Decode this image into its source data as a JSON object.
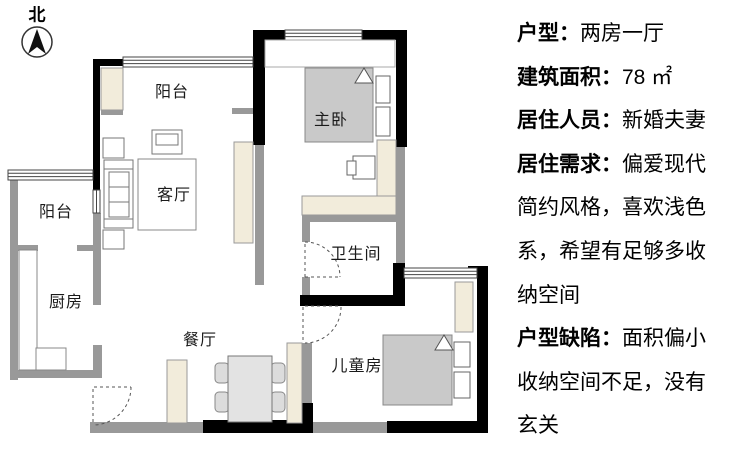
{
  "compass": {
    "label": "北"
  },
  "floorplan": {
    "rooms": [
      {
        "id": "balcony-top",
        "label": "阳台"
      },
      {
        "id": "master-bedroom",
        "label": "主卧"
      },
      {
        "id": "living-room",
        "label": "客厅"
      },
      {
        "id": "balcony-left",
        "label": "阳台"
      },
      {
        "id": "kitchen",
        "label": "厨房"
      },
      {
        "id": "bathroom",
        "label": "卫生间"
      },
      {
        "id": "dining-room",
        "label": "餐厅"
      },
      {
        "id": "kids-room",
        "label": "儿童房"
      }
    ],
    "colors": {
      "wall_black": "#000000",
      "wall_gray": "#999999",
      "furniture_beige": "#f2ecdb",
      "bed_gray": "#c9c9c9",
      "table_gray": "#e3e3e3"
    }
  },
  "info_panel": {
    "lines": [
      {
        "label": "户型：",
        "text": "两房一厅"
      },
      {
        "label": "建筑面积：",
        "text": "78 ㎡"
      },
      {
        "label": "居住人员：",
        "text": "新婚夫妻"
      },
      {
        "label": "居住需求：",
        "text": "偏爱现代"
      },
      {
        "label": "",
        "text": "简约风格，喜欢浅色"
      },
      {
        "label": "",
        "text": "系，希望有足够多收"
      },
      {
        "label": "",
        "text": "纳空间"
      },
      {
        "label": "户型缺陷：",
        "text": "面积偏小"
      },
      {
        "label": "",
        "text": "收纳空间不足，没有"
      },
      {
        "label": "",
        "text": "玄关"
      }
    ]
  }
}
